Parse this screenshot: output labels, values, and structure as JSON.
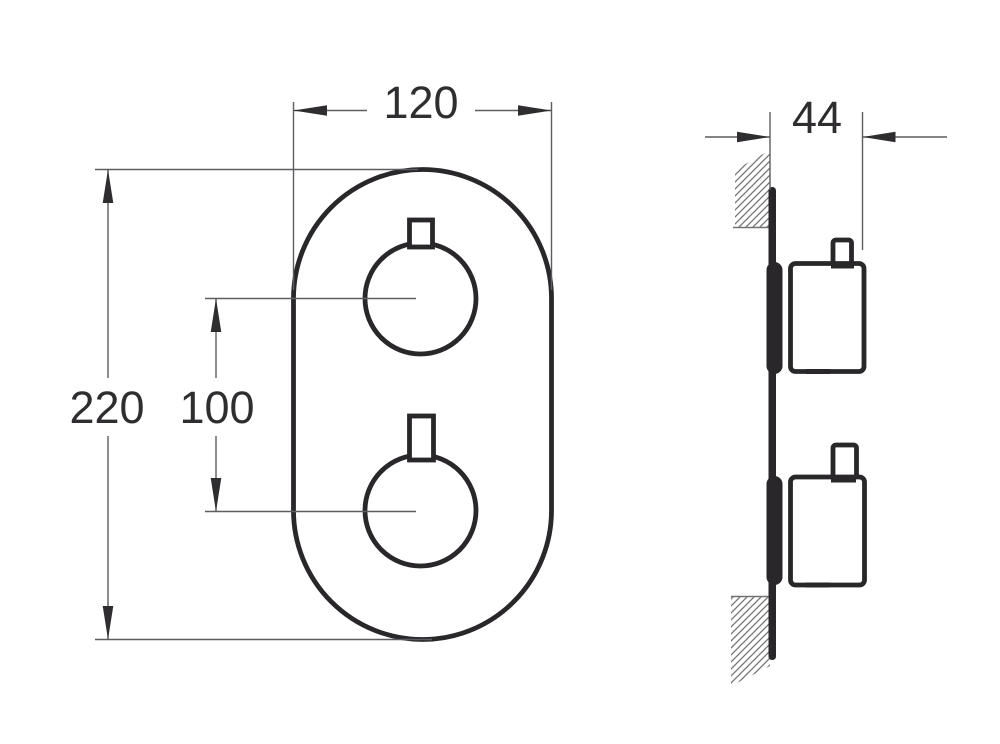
{
  "drawing": {
    "dimensions": {
      "plate_width_mm": "120",
      "plate_height_mm": "220",
      "handle_spacing_mm": "100",
      "depth_mm": "44"
    },
    "colors": {
      "outline": "#29272a",
      "dim": "#5d5d61",
      "hatch": "#737377",
      "text": "#2f2d30",
      "background": "#ffffff"
    }
  }
}
